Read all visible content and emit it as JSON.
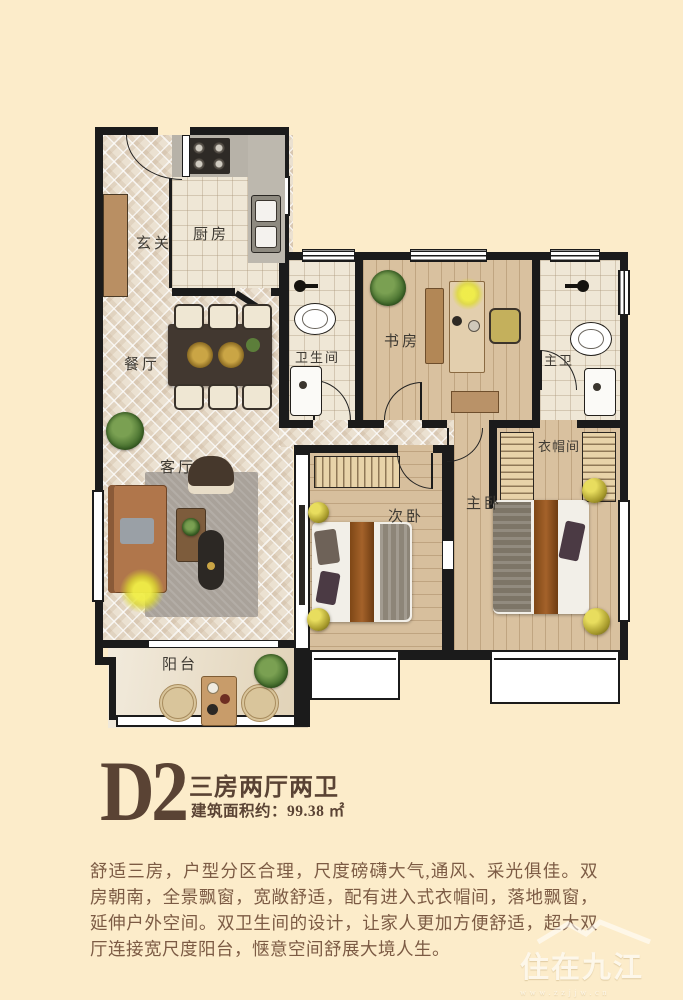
{
  "title": {
    "code": "D2",
    "layout_type": "三房两厅两卫",
    "area_label": "建筑面积约：",
    "area_value": "99.38 ㎡"
  },
  "description": "舒适三房，户型分区合理，尺度磅礴大气,通风、采光俱佳。双房朝南，全景飘窗，宽敞舒适，配有进入式衣帽间，落地飘窗，延伸户外空间。双卫生间的设计，让家人更加方便舒适，超大双厅连接宽尺度阳台，惬意空间舒展大境人生。",
  "floorplan": {
    "rooms": [
      {
        "id": "entry",
        "label": "玄关"
      },
      {
        "id": "kitchen",
        "label": "厨房"
      },
      {
        "id": "dining",
        "label": "餐厅"
      },
      {
        "id": "living",
        "label": "客厅"
      },
      {
        "id": "bathroom",
        "label": "卫生间"
      },
      {
        "id": "study",
        "label": "书房"
      },
      {
        "id": "master-bath",
        "label": "主卫"
      },
      {
        "id": "cloakroom",
        "label": "衣帽间"
      },
      {
        "id": "second-bedroom",
        "label": "次卧"
      },
      {
        "id": "master-bedroom",
        "label": "主卧"
      },
      {
        "id": "balcony",
        "label": "阳台"
      }
    ]
  },
  "watermark": {
    "name": "住在九江",
    "url": "www.zzjjw.cn"
  },
  "colors": {
    "background": "#fcecca",
    "wall": "#1b1b1b",
    "title_brown": "#5a4334",
    "body_text": "#7c5b44",
    "wood_floor": "#d9c19f",
    "lamp_yellow": "#e4e432"
  }
}
